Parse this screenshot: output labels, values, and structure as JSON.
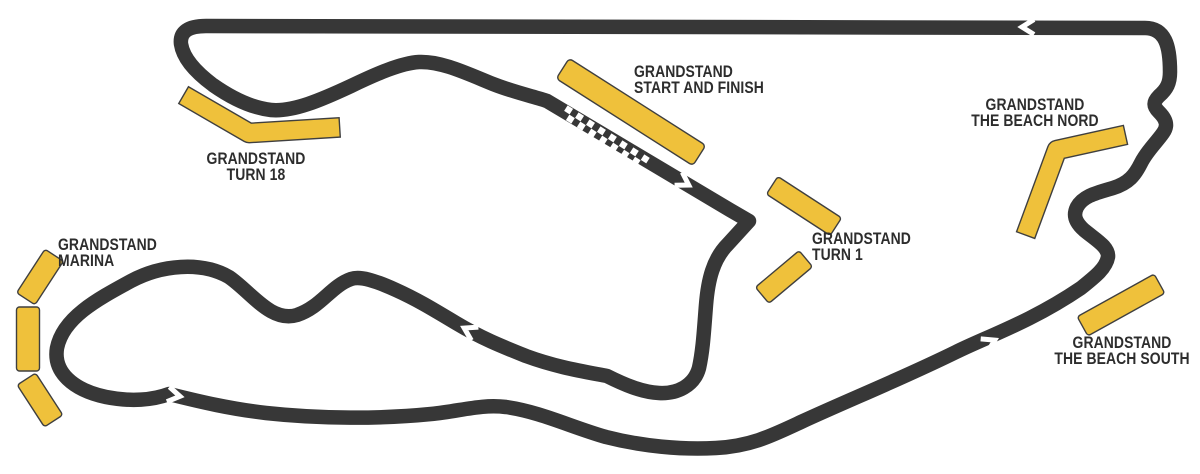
{
  "page": {
    "background": "#FFFFFF"
  },
  "map": {
    "type": "race-circuit-map",
    "colors": {
      "track": "#373737",
      "grandstand_fill": "#EFC13B",
      "grandstand_outline": "#3F3F3F",
      "label_text": "#2D2D2D",
      "direction_arrow": "#FFFFFF"
    },
    "start_finish_marking": "checkered-line",
    "direction_arrow_count": 5,
    "grandstands": [
      {
        "id": "turn-18",
        "line1": "GRANDSTAND",
        "line2": "TURN 18"
      },
      {
        "id": "start-finish",
        "line1": "GRANDSTAND",
        "line2": "START AND FINISH"
      },
      {
        "id": "the-beach-nord",
        "line1": "GRANDSTAND",
        "line2": "THE BEACH NORD"
      },
      {
        "id": "turn-1",
        "line1": "GRANDSTAND",
        "line2": "TURN 1"
      },
      {
        "id": "marina",
        "line1": "GRANDSTAND",
        "line2": "MARINA"
      },
      {
        "id": "the-beach-south",
        "line1": "GRANDSTAND",
        "line2": "THE BEACH SOUTH"
      }
    ]
  }
}
